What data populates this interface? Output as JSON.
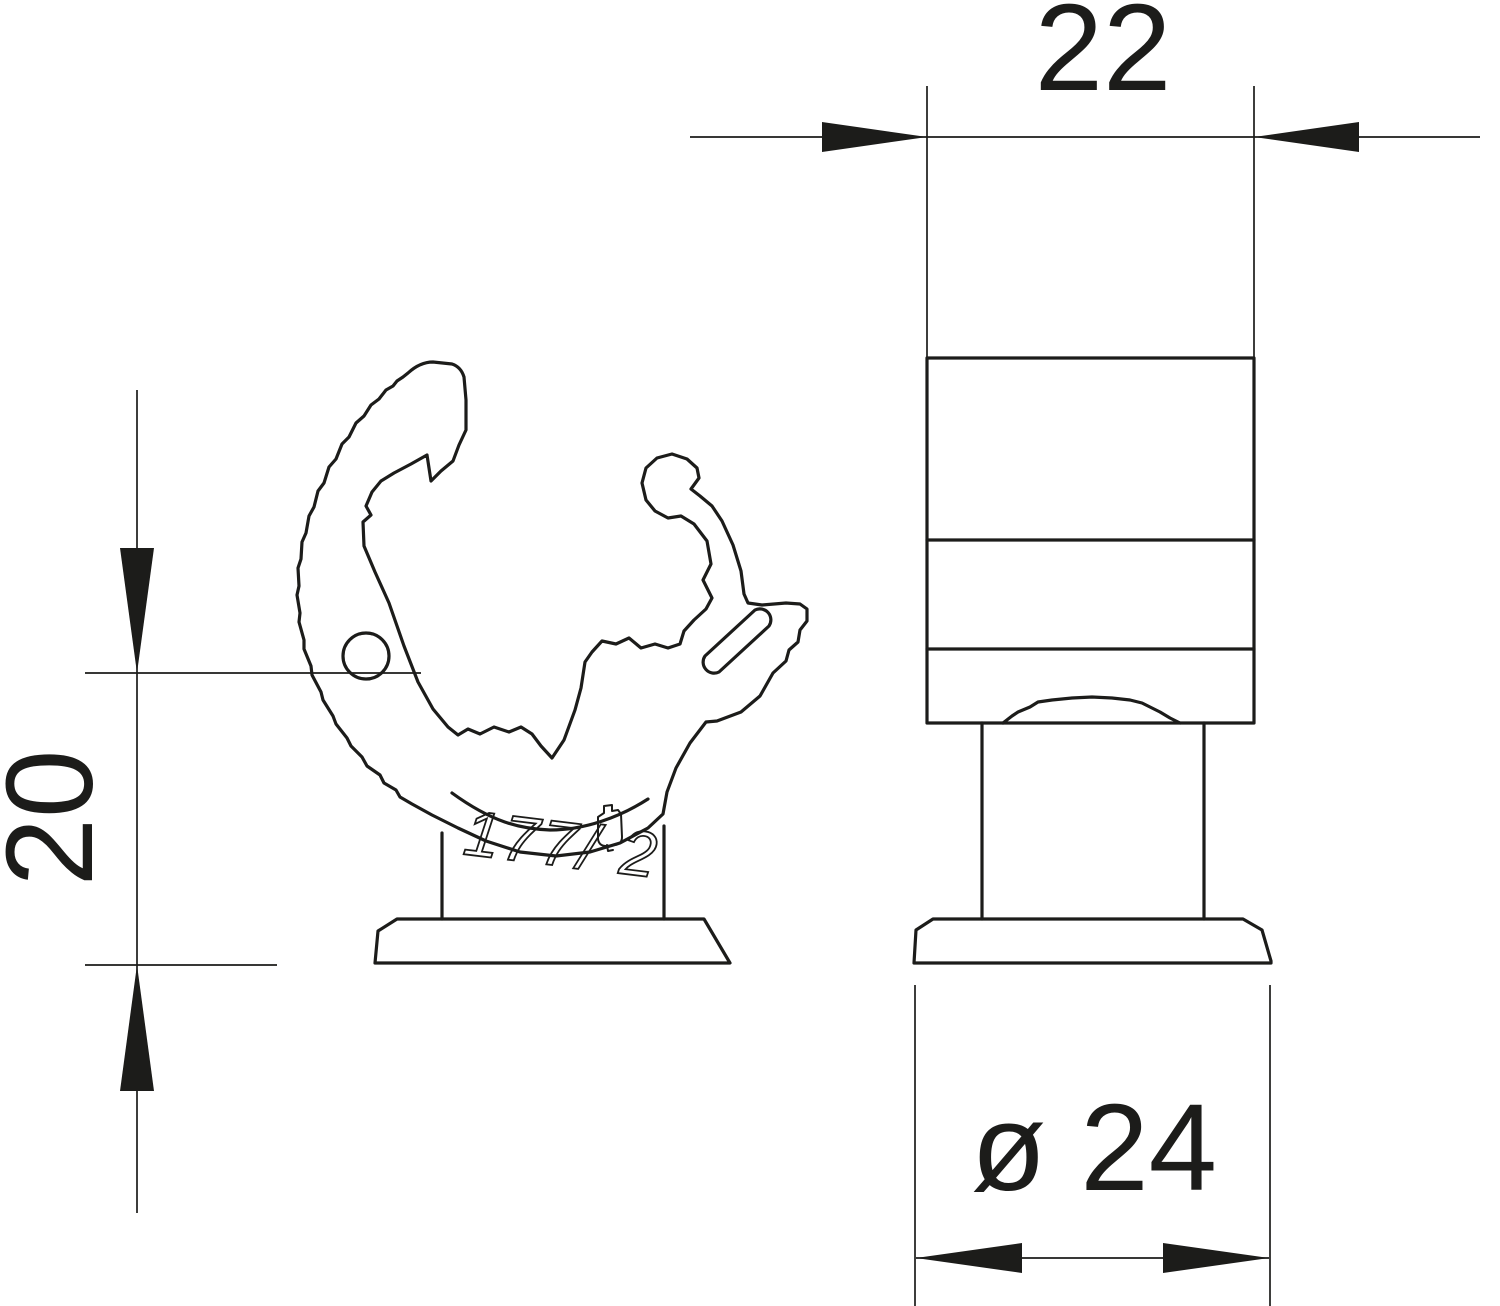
{
  "drawing": {
    "background_color": "#ffffff",
    "line_color": "#1c1c1a",
    "dimensions": {
      "width_top": "22",
      "height_left": "20",
      "diameter_bottom": "ø 24"
    },
    "engraving_text": "177/ 2"
  }
}
